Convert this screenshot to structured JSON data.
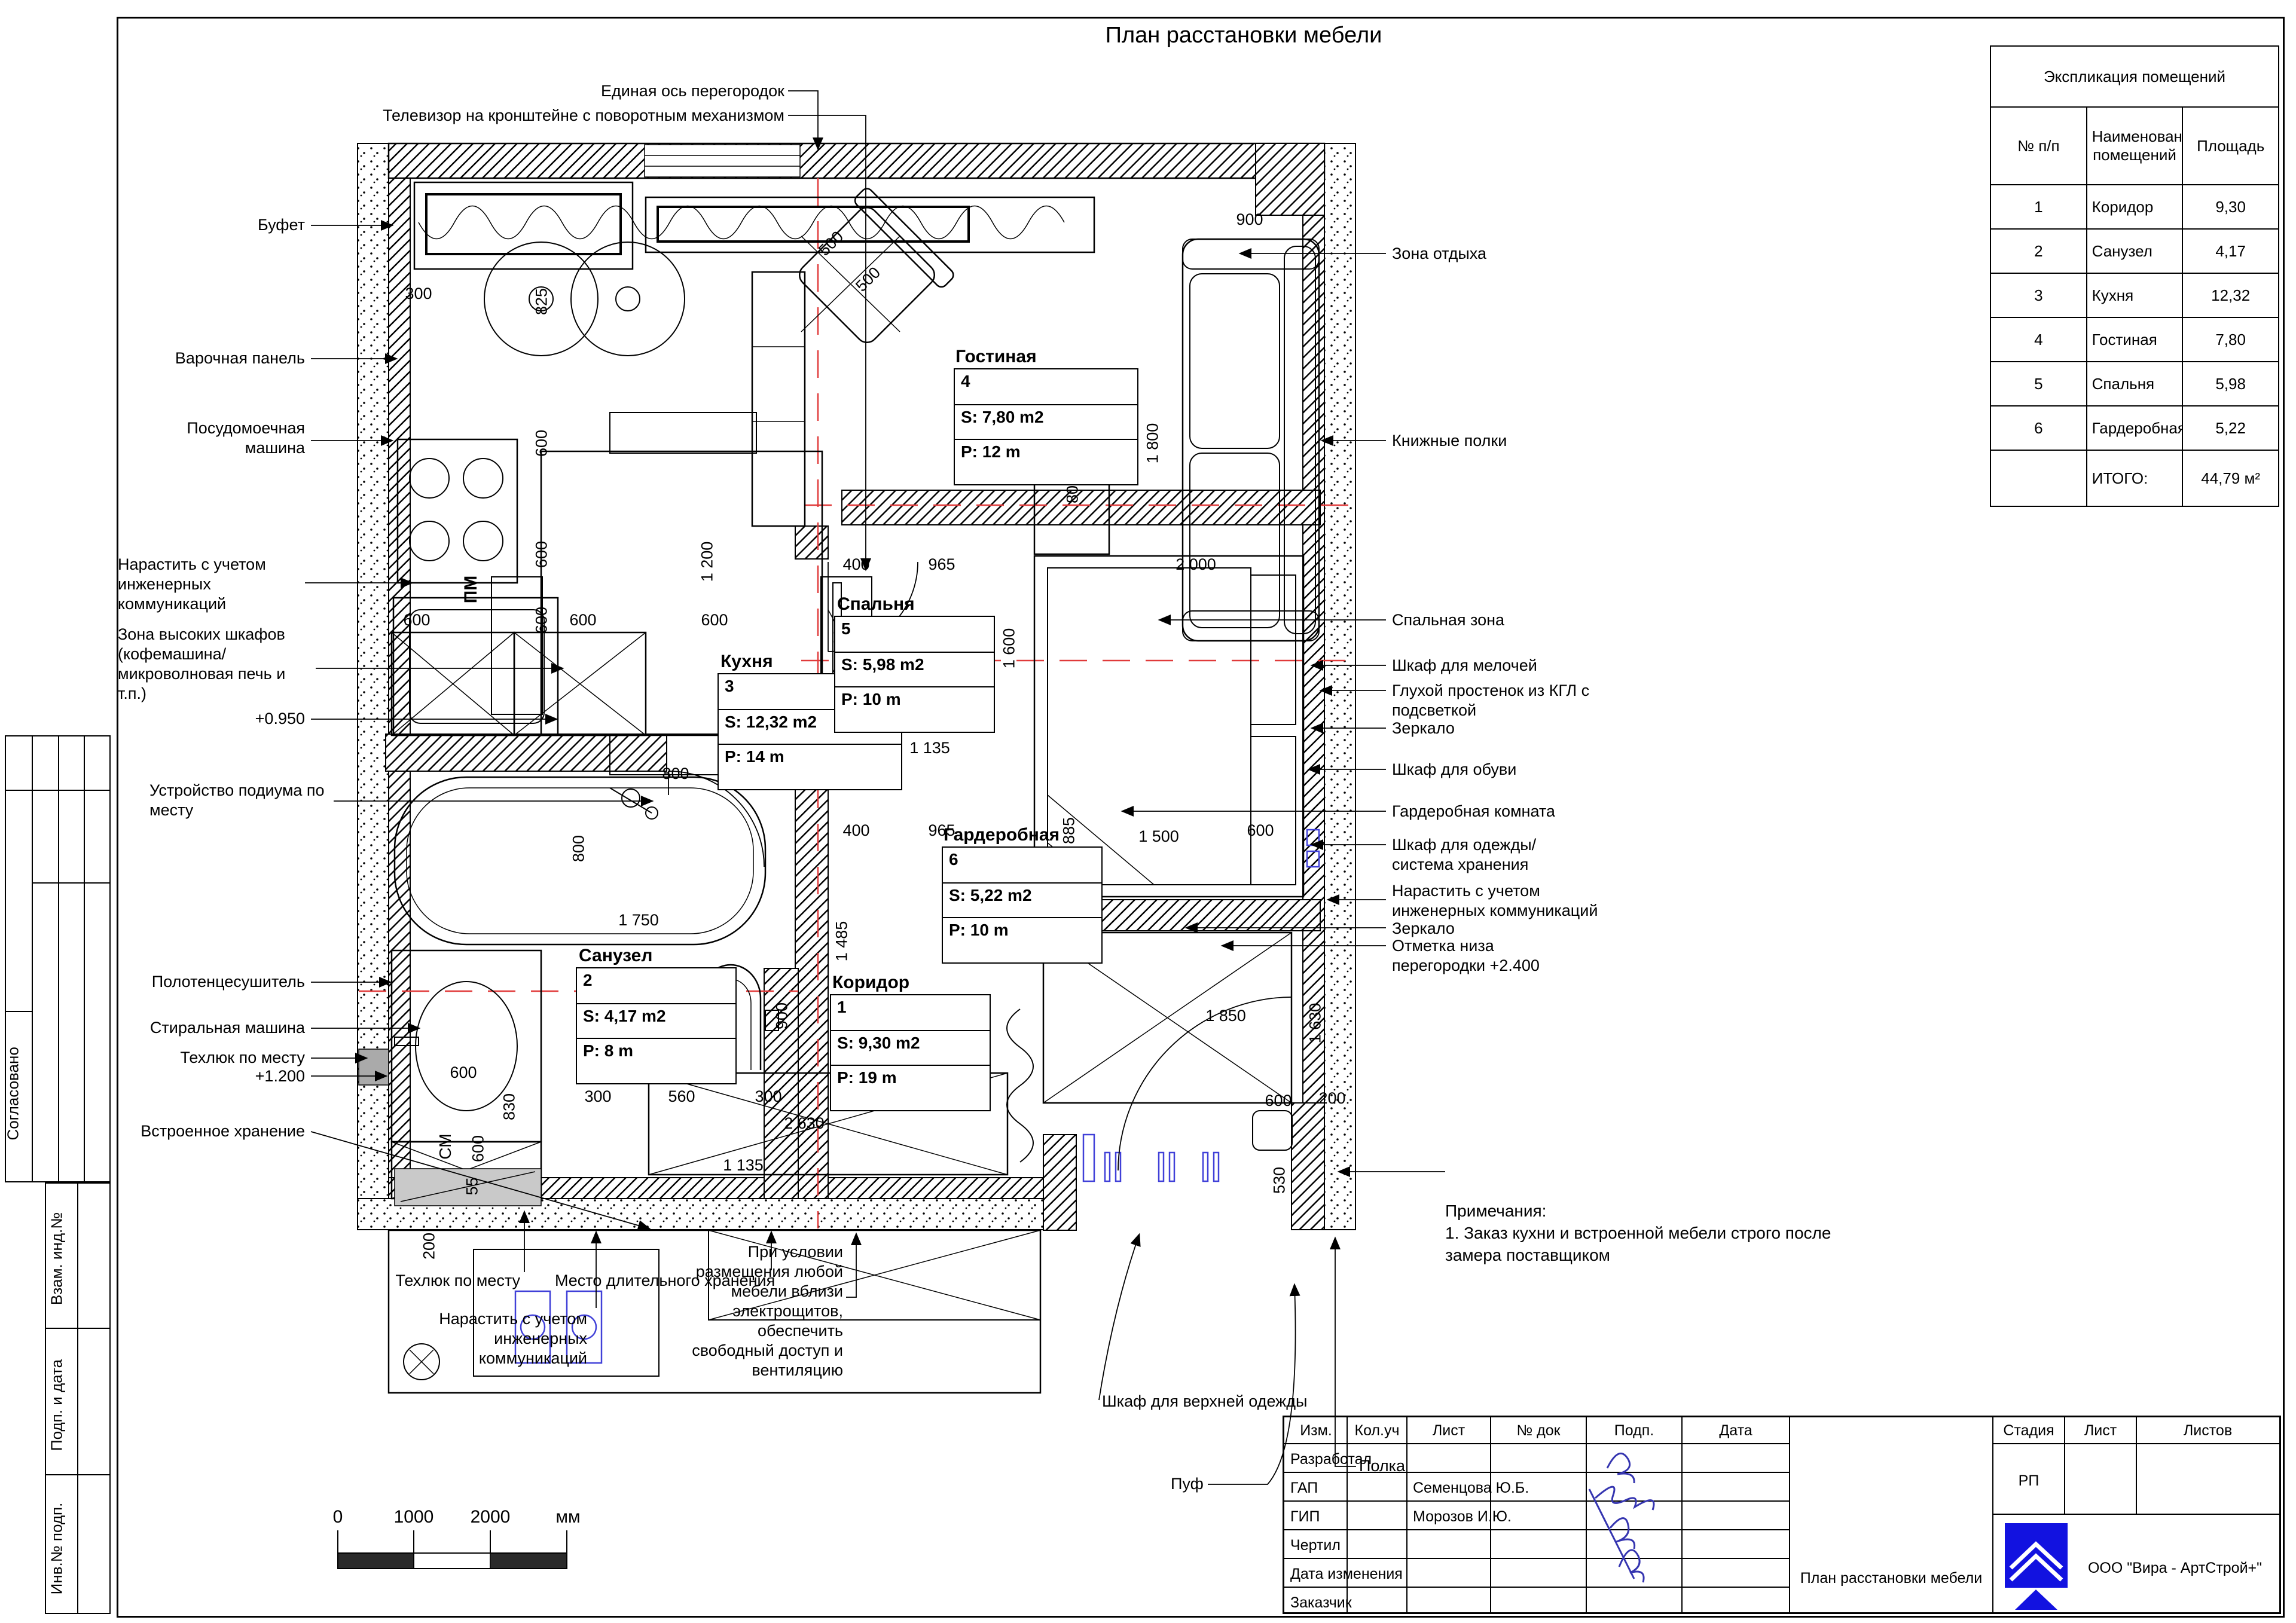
{
  "title": "План расстановки мебели",
  "explication": {
    "title": "Экспликация помещений",
    "col_num": "№ п/п",
    "col_name": "Наименование помещений",
    "col_area": "Площадь",
    "rows": [
      {
        "n": "1",
        "name": "Коридор",
        "area": "9,30"
      },
      {
        "n": "2",
        "name": "Санузел",
        "area": "4,17"
      },
      {
        "n": "3",
        "name": "Кухня",
        "area": "12,32"
      },
      {
        "n": "4",
        "name": "Гостиная",
        "area": "7,80"
      },
      {
        "n": "5",
        "name": "Спальня",
        "area": "5,98"
      },
      {
        "n": "6",
        "name": "Гардеробная",
        "area": "5,22"
      }
    ],
    "total_label": "ИТОГО:",
    "total_value": "44,79 м²"
  },
  "rooms": {
    "livingroom": {
      "name": "Гостиная",
      "num": "4",
      "s": "S: 7,80 m2",
      "p": "P: 12 m"
    },
    "kitchen": {
      "name": "Кухня",
      "num": "3",
      "s": "S: 12,32 m2",
      "p": "P: 14 m"
    },
    "bedroom": {
      "name": "Спальня",
      "num": "5",
      "s": "S: 5,98 m2",
      "p": "P: 10 m"
    },
    "wardrobe": {
      "name": "Гардеробная",
      "num": "6",
      "s": "S: 5,22 m2",
      "p": "P: 10 m"
    },
    "bathroom": {
      "name": "Санузел",
      "num": "2",
      "s": "S: 4,17 m2",
      "p": "P: 8 m"
    },
    "corridor": {
      "name": "Коридор",
      "num": "1",
      "s": "S: 9,30 m2",
      "p": "P: 19 m"
    }
  },
  "labels": {
    "top": [
      "Единая ось перегородок",
      "Телевизор на кронштейне с поворотным механизмом"
    ],
    "left": [
      "Буфет",
      "Варочная панель",
      "Посудомоечная машина",
      "Нарастить с учетом инженерных коммуникаций",
      "Зона высоких шкафов (кофемашина/ микроволновая печь и т.п.)",
      "+0.950",
      "Устройство подиума по месту",
      "Полотенцесушитель",
      "Стиральная машина",
      "Техлюк по месту",
      "+1.200",
      "Встроенное хранение"
    ],
    "right": [
      "Зона отдыха",
      "Книжные полки",
      "Спальная зона",
      "Шкаф для мелочей",
      "Глухой простенок из КГЛ с подсветкой",
      "Зеркало",
      "Шкаф для обуви",
      "Гардеробная комната",
      "Шкаф для одежды/ система хранения",
      "Нарастить с учетом инженерных коммуникаций",
      "Зеркало",
      "Отметка низа перегородки +2.400"
    ],
    "bottom": [
      "Техлюк по месту",
      "Место длительного хранения",
      "Нарастить с учетом инженерных коммуникаций",
      "При условии размещения любой мебели вблизи электрощитов, обеспечить свободный доступ и вентиляцию",
      "Шкаф для верхней одежды",
      "Пуф",
      "Полка"
    ],
    "pm": "ПМ",
    "cm": "СМ"
  },
  "notes": {
    "title": "Примечания:",
    "body1": "1. Заказ кухни и встроенной мебели строго после",
    "body2": "замера поставщиком"
  },
  "dims": [
    "300",
    "825",
    "600",
    "600",
    "600",
    "600",
    "600",
    "600",
    "1 200",
    "800",
    "500",
    "500",
    "900",
    "400",
    "800",
    "1 800",
    "400",
    "965",
    "2 000",
    "1 700",
    "1 600",
    "400",
    "965",
    "885",
    "1 500",
    "600",
    "1 850",
    "600",
    "1 485",
    "800",
    "1 750",
    "1 135",
    "600",
    "830",
    "600",
    "300",
    "560",
    "300",
    "55",
    "200",
    "900",
    "1 495",
    "2 630",
    "1 135",
    "600",
    "530",
    "200",
    "1 630"
  ],
  "scalebar": {
    "t0": "0",
    "t1": "1000",
    "t2": "2000",
    "unit": "мм"
  },
  "titleblock": {
    "c0": "Изм.",
    "c1": "Кол.уч",
    "c2": "Лист",
    "c3": "№ док",
    "c4": "Подп.",
    "c5": "Дата",
    "r0": "Разработал",
    "r1": "ГАП",
    "r2": "ГИП",
    "r3": "Чертил",
    "r4": "Дата изменения",
    "r5": "Заказчик",
    "n1": "Семенцова Ю.Б.",
    "n2": "Морозов И.Ю.",
    "doc_title": "План расстановки мебели",
    "stage_label": "Стадия",
    "sheet_label": "Лист",
    "sheets_label": "Листов",
    "stage_value": "РП",
    "company": "ООО \"Вира - АртСтрой+\""
  },
  "side": {
    "agreed": "Согласовано",
    "vzam": "Взам. инд.№",
    "podp": "Подп. и дата",
    "inv": "Инв.№ подп."
  },
  "colors": {
    "axis_red": "#e03a3a",
    "signature_blue": "#3535b0",
    "logo_blue": "#1212e0",
    "door_blue": "#4040d8"
  }
}
